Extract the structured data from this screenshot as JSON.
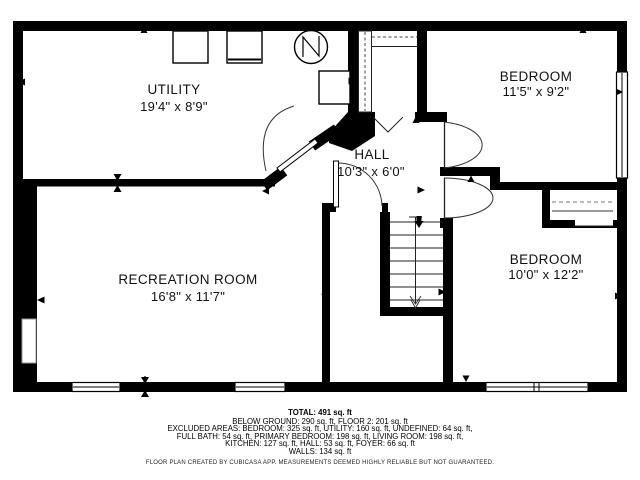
{
  "title": "Floor plan - below ground level",
  "colors": {
    "background": "#ffffff",
    "walls": "#000000",
    "text": "#111111"
  },
  "rooms": {
    "utility": {
      "name": "UTILITY",
      "dimensions": "19'4\" x 8'9\""
    },
    "bedroom_top": {
      "name": "BEDROOM",
      "dimensions": "11'5\" x 9'2\""
    },
    "hall": {
      "name": "HALL",
      "dimensions": "10'3\" x 6'0\""
    },
    "recreation": {
      "name": "RECREATION ROOM",
      "dimensions": "16'8\" x 11'7\""
    },
    "bedroom_bottom": {
      "name": "BEDROOM",
      "dimensions": "10'0\" x 12'2\""
    }
  },
  "icons": {
    "washer": "washer-icon",
    "dryer": "dryer-icon",
    "water_heater": "water-heater-icon",
    "furnace": "furnace-icon",
    "stairs_down": "stairs-down-icon",
    "stairs_up": "stairs-up-icon"
  },
  "footer": {
    "total": "TOTAL: 491 sq. ft",
    "line1": "BELOW GROUND: 290 sq. ft, FLOOR 2: 201 sq. ft",
    "line2": "EXCLUDED AREAS: BEDROOM: 325 sq. ft, UTILITY: 160 sq. ft, UNDEFINED: 64 sq. ft,",
    "line3": "FULL BATH: 54 sq. ft, PRIMARY BEDROOM: 198 sq. ft, LIVING ROOM: 198 sq. ft,",
    "line4": "KITCHEN: 127 sq. ft, HALL: 53 sq. ft, FOYER: 66 sq. ft",
    "line5": "WALLS: 134 sq. ft",
    "disclaimer": "FLOOR PLAN CREATED BY CUBICASA APP. MEASUREMENTS DEEMED HIGHLY RELIABLE BUT NOT GUARANTEED."
  }
}
